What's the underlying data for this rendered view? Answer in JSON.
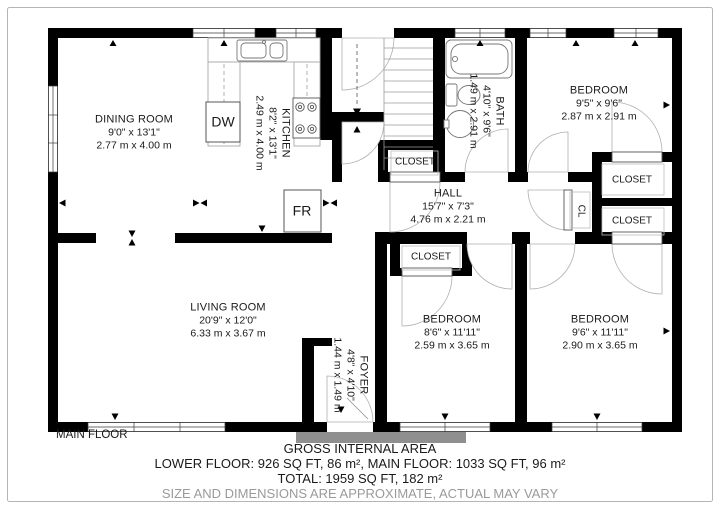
{
  "floor_label": "MAIN FLOOR",
  "footer": {
    "title": "GROSS INTERNAL AREA",
    "areas_line": "LOWER FLOOR: 926 SQ FT, 86 m², MAIN FLOOR: 1033 SQ FT, 96 m²",
    "total_line": "TOTAL: 1959 SQ FT, 182 m²",
    "disclaimer": "SIZE AND DIMENSIONS ARE APPROXIMATE, ACTUAL MAY VARY"
  },
  "rooms": [
    {
      "name": "DINING ROOM",
      "imperial": "9'0\" x 13'1\"",
      "metric": "2.77 m x 4.00 m"
    },
    {
      "name": "KITCHEN",
      "imperial": "8'2\" x 13'1\"",
      "metric": "2.49 m x 4.00 m"
    },
    {
      "name": "BATH",
      "imperial": "4'10\" x 9'6\"",
      "metric": "1.49 m x 2.91 m"
    },
    {
      "name": "BEDROOM",
      "imperial": "9'5\" x 9'6\"",
      "metric": "2.87 m x 2.91 m"
    },
    {
      "name": "HALL",
      "imperial": "15'7\" x 7'3\"",
      "metric": "4.76 m x 2.21 m"
    },
    {
      "name": "LIVING ROOM",
      "imperial": "20'9\" x 12'0\"",
      "metric": "6.33 m x 3.67 m"
    },
    {
      "name": "FOYER",
      "imperial": "4'8\" x 4'10\"",
      "metric": "1.44 m x 1.49 m"
    },
    {
      "name": "BEDROOM",
      "imperial": "8'6\" x 11'11\"",
      "metric": "2.59 m x 3.65 m"
    },
    {
      "name": "BEDROOM",
      "imperial": "9'6\" x 11'11\"",
      "metric": "2.90 m x 3.65 m"
    }
  ],
  "closets": {
    "closet": "CLOSET",
    "cl": "CL"
  },
  "appliances": {
    "dishwasher": "DW",
    "fridge": "FR"
  },
  "colors": {
    "wall": "#000000",
    "fixture_outline": "#9a9a9a",
    "disclaimer_text": "#9a9a9a",
    "step_gray": "#8f8f8f"
  }
}
